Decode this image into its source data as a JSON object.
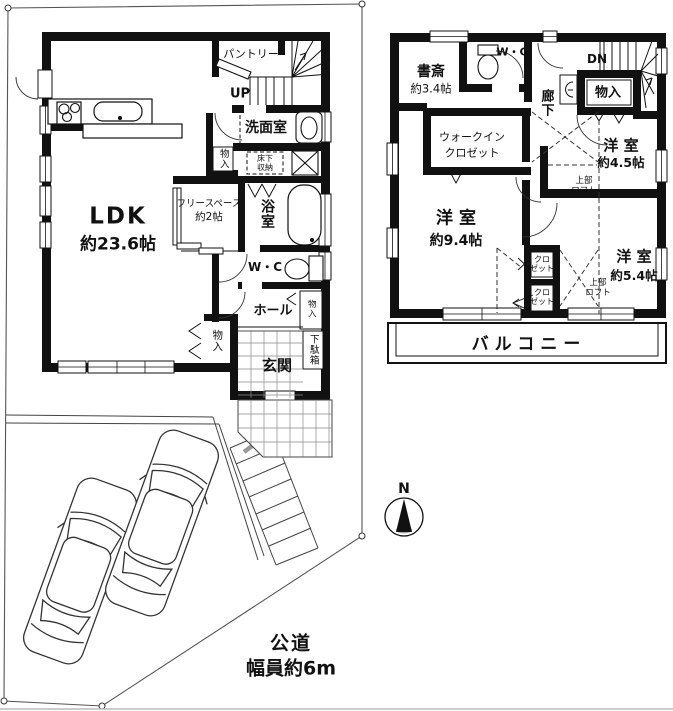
{
  "site": {
    "road_label_line1": "公道",
    "road_label_line2": "幅員約6m",
    "compass_n": "N"
  },
  "floor1": {
    "ldk_name": "LDK",
    "ldk_size": "約23.6帖",
    "pantry": "パントリー",
    "stairs_up": "UP",
    "washroom": "洗面室",
    "storage_washroom": "物入",
    "underfloor_line1": "床下",
    "underfloor_line2": "収納",
    "freespace_line1": "フリースペース",
    "freespace_line2": "約2帖",
    "bathroom": "浴室",
    "toilet": "W・C",
    "hall": "ホール",
    "storage_hall": "物入",
    "storage_entrance": "物入",
    "shoe_cabinet": "下駄箱",
    "entrance": "玄関"
  },
  "floor2": {
    "study_name": "書斎",
    "study_size": "約3.4帖",
    "toilet": "W・C",
    "stairs_down": "DN",
    "corridor": "廊下",
    "storage": "物入",
    "wic_line1": "ウォークイン",
    "wic_line2": "クロゼット",
    "room45_name": "洋 室",
    "room45_size": "約4.5帖",
    "loft45_line1": "上部",
    "loft45_line2": "ロフト",
    "room94_name": "洋 室",
    "room94_size": "約9.4帖",
    "closet1_line1": "クロ",
    "closet1_line2": "ゼット",
    "closet2_line1": "クロ",
    "closet2_line2": "ゼット",
    "loft54_line1": "上部",
    "loft54_line2": "ロフト",
    "room54_name": "洋 室",
    "room54_size": "約5.4帖",
    "balcony": "バルコニー"
  }
}
